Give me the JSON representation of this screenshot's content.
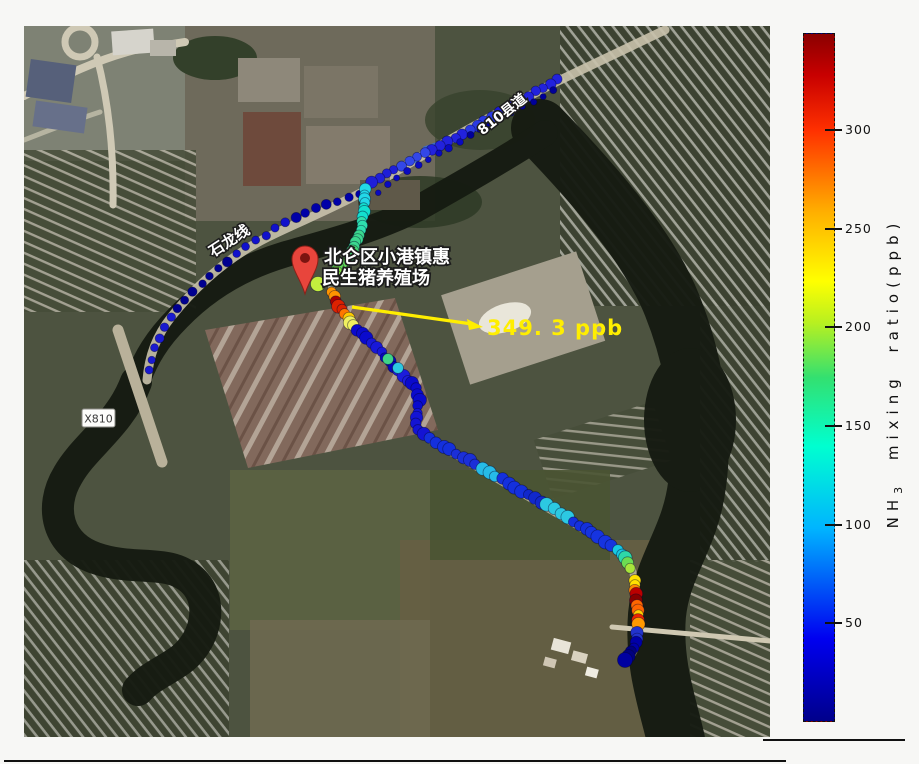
{
  "figure": {
    "map": {
      "labels": {
        "farm_name_line1": "北仑区小港镇惠",
        "farm_name_line2": "民生猪养殖场",
        "road_shilong": "石龙线",
        "road_x810_county": "810县道",
        "road_badge": "X810"
      },
      "annotation": {
        "peak_text": "349. 3 ppb",
        "peak_color": "#ffee00"
      }
    },
    "colorbar": {
      "label_prefix": "NH",
      "label_subscript": "3",
      "label_suffix": "mixing ratio(ppb)"
    }
  },
  "chart_data": {
    "type": "scatter",
    "title": "",
    "peak_value_ppb": 349.3,
    "colorbar": {
      "label": "NH3 mixing ratio (ppb)",
      "ticks": [
        50,
        100,
        150,
        200,
        250,
        300
      ],
      "min": 0,
      "max": 349.3,
      "colormap": "jet",
      "gradient_stops": [
        "#00008b 0%",
        "#0000f0 12%",
        "#00b4ff 28%",
        "#00ffd0 40%",
        "#33e070 50%",
        "#b8f020 58%",
        "#ffff00 64%",
        "#ffb000 74%",
        "#ff3000 86%",
        "#c80000 94%",
        "#8b0000 100%"
      ],
      "geometry": {
        "left": 803,
        "top": 33,
        "width": 32,
        "height": 689
      }
    },
    "track_segments": [
      {
        "name": "road-ne-upper",
        "r": 5,
        "spacing": 8.5,
        "colors": [
          "#2222dd",
          "#1b1bd4",
          "#2a3ae2",
          "#2222dd",
          "#3347e8",
          "#1f1fd8"
        ],
        "points": [
          [
            558,
            79
          ],
          [
            505,
            109
          ],
          [
            452,
            140
          ],
          [
            398,
            167
          ],
          [
            366,
            187
          ]
        ]
      },
      {
        "name": "road-ne-lower",
        "r": 3.2,
        "spacing": 12,
        "colors": [
          "#000099",
          "#0a0ac0"
        ],
        "points": [
          [
            554,
            90
          ],
          [
            500,
            118
          ],
          [
            448,
            148
          ],
          [
            402,
            175
          ],
          [
            372,
            196
          ]
        ]
      },
      {
        "name": "road-west",
        "r": 4.4,
        "spacing": 11.5,
        "colors": [
          "#0000a8",
          "#1111cc",
          "#000090",
          "#1a1ad0"
        ],
        "points": [
          [
            360,
            194
          ],
          [
            322,
            206
          ],
          [
            283,
            224
          ],
          [
            248,
            246
          ],
          [
            215,
            272
          ],
          [
            188,
            297
          ],
          [
            168,
            322
          ],
          [
            155,
            348
          ],
          [
            148,
            375
          ]
        ]
      },
      {
        "name": "south-descent",
        "r": 5.5,
        "spacing": 4.5,
        "colors": [
          "#22d8e8",
          "#12dfd0",
          "#2edfae",
          "#3bd88e",
          "#46d873",
          "#62da58",
          "#86df46"
        ],
        "points": [
          [
            366,
            190
          ],
          [
            364,
            212
          ],
          [
            361,
            232
          ],
          [
            352,
            252
          ],
          [
            340,
            266
          ],
          [
            330,
            284
          ]
        ]
      },
      {
        "name": "hotspot-farm",
        "r": 5.8,
        "spacing": 5,
        "colors": [
          "#ff9500",
          "#aa0000",
          "#dd2200",
          "#ff7700",
          "#ffcc00",
          "#f0f060"
        ],
        "points": [
          [
            331,
            293
          ],
          [
            337,
            302
          ],
          [
            343,
            311
          ],
          [
            349,
            319
          ],
          [
            354,
            326
          ]
        ]
      },
      {
        "name": "diag-1",
        "r": 5.6,
        "spacing": 6.5,
        "colors": [
          "#0a0acd",
          "#1818d8",
          "#0707bb",
          "#1c1cdc"
        ],
        "points": [
          [
            357,
            330
          ],
          [
            381,
            352
          ],
          [
            409,
            381
          ]
        ]
      },
      {
        "name": "s-curve",
        "r": 5.6,
        "spacing": 6,
        "colors": [
          "#0a0acd",
          "#1414d4"
        ],
        "points": [
          [
            412,
            384
          ],
          [
            417,
            392
          ],
          [
            419,
            402
          ],
          [
            417,
            412
          ],
          [
            415,
            420
          ],
          [
            419,
            429
          ],
          [
            426,
            436
          ]
        ]
      },
      {
        "name": "diag-2",
        "r": 5.8,
        "spacing": 7.5,
        "colors": [
          "#1430dd",
          "#1b2fd8",
          "#26bbe8",
          "#1430dd",
          "#1128cc",
          "#2cc9e2",
          "#1430dd",
          "#1634e0"
        ],
        "points": [
          [
            430,
            439
          ],
          [
            470,
            461
          ],
          [
            510,
            484
          ],
          [
            550,
            507
          ],
          [
            588,
            530
          ],
          [
            612,
            546
          ]
        ]
      },
      {
        "name": "turn-south",
        "r": 5.8,
        "spacing": 5.5,
        "colors": [
          "#16c8e4",
          "#2ed8a8",
          "#6cdc52",
          "#a8e43c"
        ],
        "points": [
          [
            617,
            551
          ],
          [
            625,
            558
          ],
          [
            630,
            566
          ],
          [
            632,
            573
          ]
        ]
      },
      {
        "name": "hotspot-bridge",
        "r": 5.8,
        "spacing": 5,
        "colors": [
          "#ffe000",
          "#ff8800",
          "#bb0000",
          "#880000",
          "#ff6600",
          "#ffd000",
          "#ee2200",
          "#ff9900"
        ],
        "points": [
          [
            634,
            580
          ],
          [
            636,
            592
          ],
          [
            637,
            604
          ],
          [
            638,
            616
          ],
          [
            638,
            628
          ]
        ]
      },
      {
        "name": "tail-south",
        "r": 5.6,
        "spacing": 5,
        "colors": [
          "#2233cc",
          "#0000a8",
          "#000080"
        ],
        "points": [
          [
            638,
            633
          ],
          [
            635,
            644
          ],
          [
            630,
            653
          ],
          [
            626,
            659
          ]
        ]
      }
    ],
    "highlight_dots": [
      {
        "x": 318,
        "y": 284,
        "r": 7.5,
        "color": "#c3ee3e"
      },
      {
        "x": 388,
        "y": 359,
        "r": 5.5,
        "color": "#3fd487"
      },
      {
        "x": 398,
        "y": 368,
        "r": 5.5,
        "color": "#2cc9e2"
      },
      {
        "x": 625,
        "y": 660,
        "r": 7.5,
        "color": "#0000a0"
      }
    ]
  }
}
